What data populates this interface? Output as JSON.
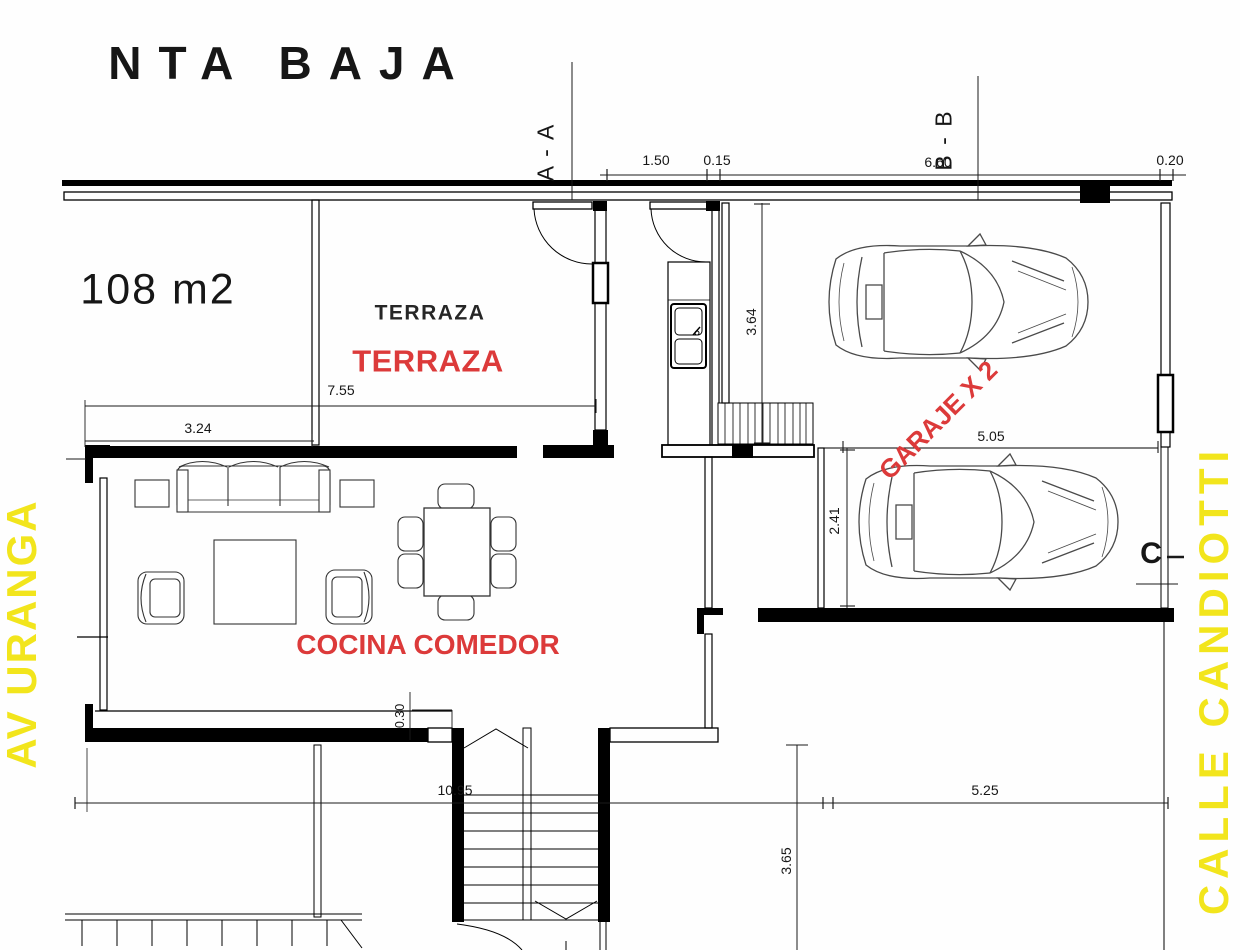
{
  "header": {
    "title": "NTA  BAJA"
  },
  "sections": {
    "aa": "A - A",
    "bb": "B - B",
    "c_marker": "C"
  },
  "labels": {
    "area": "108 m2",
    "terraza_caption": "TERRAZA",
    "terraza": "TERRAZA",
    "cocina_comedor": "COCINA COMEDOR",
    "garaje": "GARAJE X 2"
  },
  "streets": {
    "left": "AV URANGA",
    "right": "CALLE CANDIOTTI"
  },
  "dimensions": {
    "top_1": "1.50",
    "top_2": "0.15",
    "top_3": "6.60",
    "top_4": "0.20",
    "terraza_width": "7.55",
    "terraza_left": "3.24",
    "garage_depth": "3.64",
    "garage_width": "5.05",
    "bay_depth": "2.41",
    "wall_offset": "0.30",
    "bottom_width": "10.95",
    "driveway_width": "5.25",
    "driveway_depth": "3.65"
  },
  "colors": {
    "wall": "#000000",
    "accent_red": "#dc3a3a",
    "street_yellow": "#f2e51c",
    "car_outline": "#4a4a4a"
  }
}
